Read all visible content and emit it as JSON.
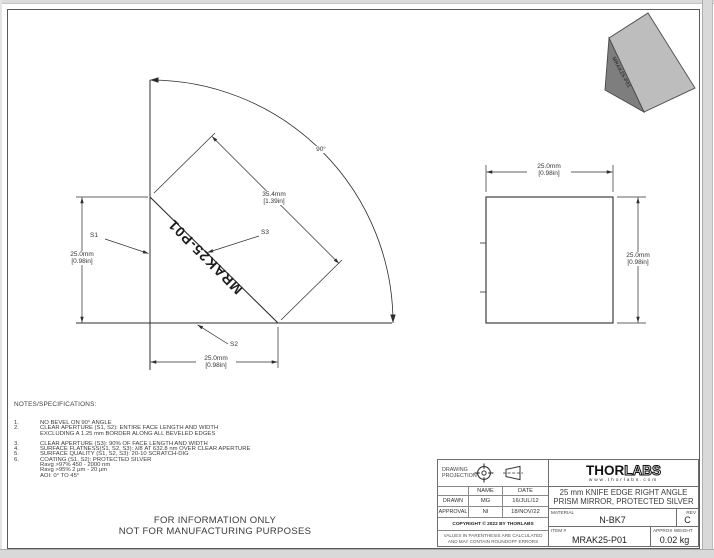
{
  "front_view": {
    "engraving": "MRAK25-P01",
    "angle_label": "90°",
    "height_dim": {
      "mm": "25.0mm",
      "in": "[0.98in]"
    },
    "width_dim": {
      "mm": "25.0mm",
      "in": "[0.98in]"
    },
    "hyp_dim": {
      "mm": "35.4mm",
      "in": "[1.39in]"
    },
    "s1": "S1",
    "s2": "S2",
    "s3": "S3"
  },
  "side_view": {
    "width_dim": {
      "mm": "25.0mm",
      "in": "[0.98in]"
    },
    "height_dim": {
      "mm": "25.0mm",
      "in": "[0.98in]"
    }
  },
  "iso_view": {
    "engraving": "MRAK25-P01",
    "face_light_color": "#bdbdbd",
    "face_dark_color": "#7e7e7e"
  },
  "notes": {
    "heading": "NOTES/SPECIFICATIONS:",
    "items": [
      {
        "num": "1.",
        "l0": "NO BEVEL ON 90° ANGLE"
      },
      {
        "num": "2.",
        "l0": "CLEAR APERTURE (S1, S2): ENTIRE FACE LENGTH AND WIDTH",
        "l1": "EXCLUDING A 1.25 mm BORDER ALONG ALL BEVELED EDGES"
      },
      {
        "num": "3.",
        "l0": "CLEAR APERTURE (S3): 90% OF FACE LENGTH AND WIDTH"
      },
      {
        "num": "4.",
        "l0": "SURFACE FLATNESS(S1, S2, S3): λ/8 AT 632.8 nm OVER CLEAR APERTURE"
      },
      {
        "num": "5.",
        "l0": "SURFACE QUALITY (S1, S2, S3): 20-10 SCRATCH-DIG"
      },
      {
        "num": "6.",
        "l0": "COATING (S1, S2): PROTECTED SILVER",
        "l1": "Ravg >97% 450 - 2000 nm",
        "l2": "Ravg >95% 2 μm - 20 μm",
        "l3": "AOI: 0° TO 45°"
      }
    ],
    "info_line1": "FOR INFORMATION ONLY",
    "info_line2": "NOT FOR MANUFACTURING PURPOSES"
  },
  "title_block": {
    "projection_label": "DRAWING PROJECTION",
    "name_header": "NAME",
    "date_header": "DATE",
    "drawn_label": "DRAWN",
    "drawn_name": "MG",
    "drawn_date": "16/JUL/12",
    "approval_label": "APPROVAL",
    "approval_name": "NI",
    "approval_date": "18/NOV/22",
    "copyright": "COPYRIGHT © 2022 BY THORLABS",
    "disclaimer1": "VALUES IN PARENTHESIS ARE CALCULATED",
    "disclaimer2": "AND MAY CONTAIN ROUNDOFF ERRORS",
    "logo_thor": "THOR",
    "logo_labs": "LABS",
    "website": "www.thorlabs.com",
    "title_line1": "25 mm KNIFE EDGE RIGHT ANGLE",
    "title_line2": "PRISM MIRROR, PROTECTED SILVER",
    "material_label": "MATERIAL",
    "material": "N-BK7",
    "rev_label": "REV",
    "rev": "C",
    "item_label": "ITEM #",
    "item": "MRAK25-P01",
    "weight_label": "APPROX WEIGHT",
    "weight": "0.02 kg"
  }
}
